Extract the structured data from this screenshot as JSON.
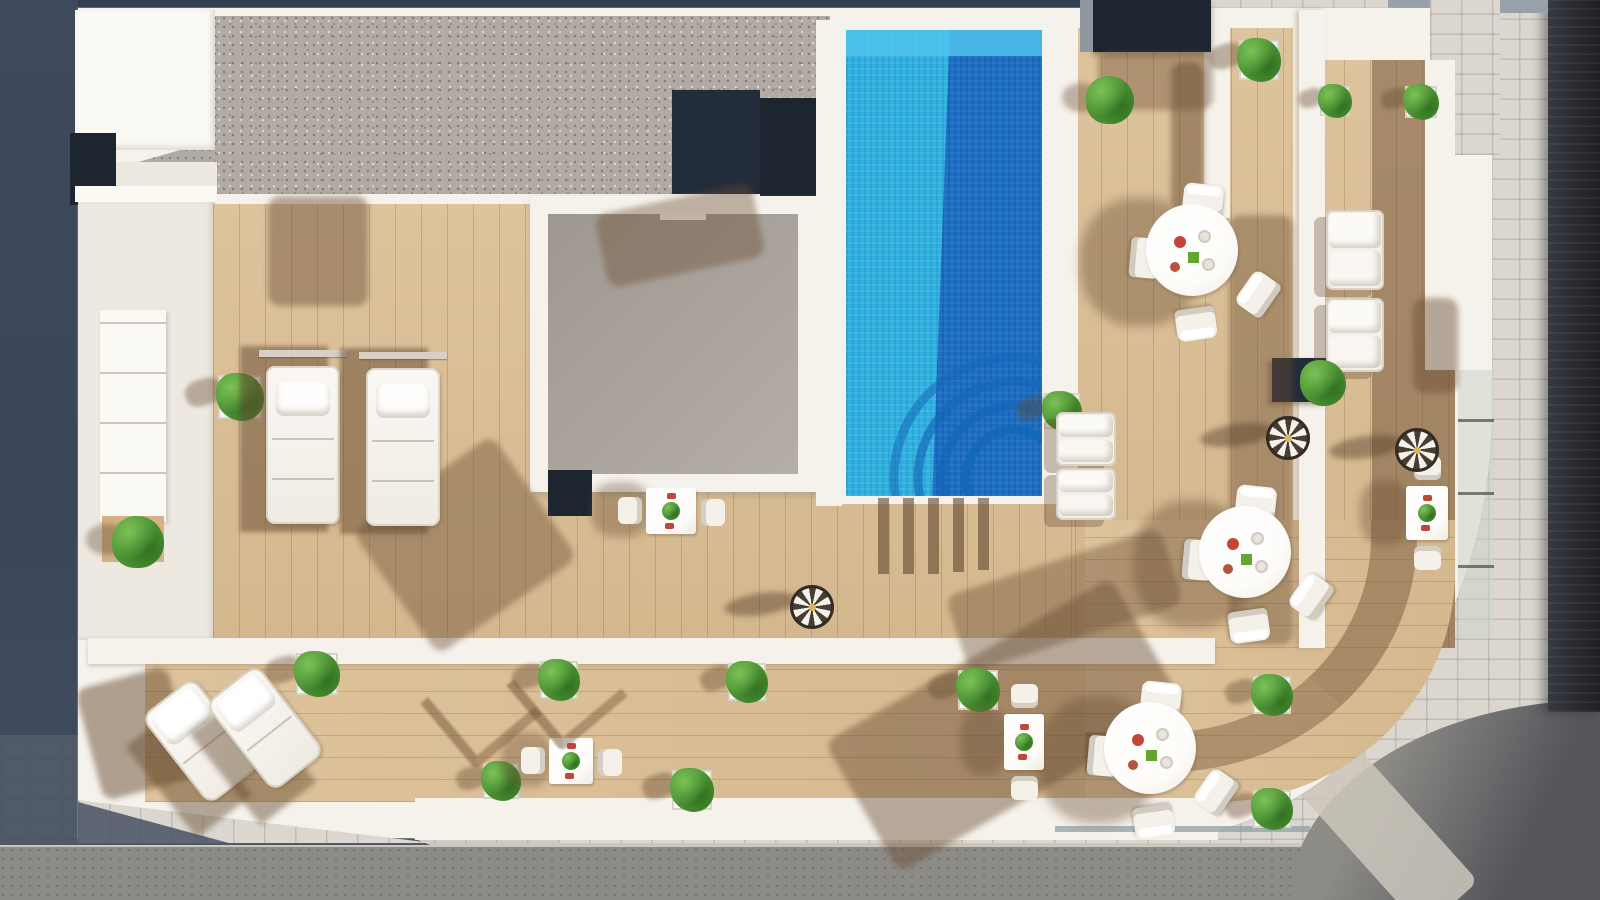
{
  "scene": {
    "label": "rooftop-terrace-aerial-render",
    "width": 1600,
    "height": 900
  },
  "palette": {
    "slate": "#3E4A5C",
    "slate_dark": "#333E4E",
    "navy": "#1D2531",
    "navy2": "#232C3A",
    "white_wall": "#F5F2EB",
    "white_soft": "#EDE9E0",
    "white_bright": "#FBF9F4",
    "gravel": "#B2ABA3",
    "gravel_dot_dark": "#857E76",
    "gravel_dot_light": "#DCD7CF",
    "wood": "#DBBF95",
    "wood2": "#D2B286",
    "wood_line": "rgba(125,95,60,.28)",
    "wood_dark": "#8B6F51",
    "shadow_brown": "rgba(104,76,50,.5)",
    "courtyard": "#A9A29A",
    "courtyard2": "#B5AEA6",
    "pool_light": "#2FB2E1",
    "pool_shallow": "#4FC3EC",
    "pool_dark": "#1C6FC4",
    "pool_steps": "#1467B8",
    "paving": "#DBD7CF",
    "paving_line": "rgba(125,120,110,.28)",
    "road": "#8D8B86",
    "road_dark": "#55565C",
    "crosswalk": "#CCC7BC",
    "charcoal": "#2B2D33",
    "charcoal2": "#1E2026",
    "glass": "rgba(205,214,203,.55)",
    "glass_edge": "#8FA0A6",
    "green": "#4C9334",
    "green_hi": "#7CC257",
    "green_dark": "#2F6E1F",
    "table_white": "#FDFCF9",
    "chair_white": "#F4F1EA",
    "rail": "#D6D0C6",
    "parasol_dark": "#463D33",
    "item_red": "#C5443A",
    "item_green": "#63A52F",
    "item_cup": "#E8E4DC"
  },
  "furniture": {
    "planters": [
      {
        "x": 218,
        "y": 375,
        "s": 44
      },
      {
        "x": 1239,
        "y": 40,
        "s": 40
      },
      {
        "x": 1320,
        "y": 86,
        "s": 30
      },
      {
        "x": 1405,
        "y": 86,
        "s": 32
      },
      {
        "x": 1044,
        "y": 393,
        "s": 36
      },
      {
        "x": 296,
        "y": 653,
        "s": 42
      },
      {
        "x": 540,
        "y": 661,
        "s": 38
      },
      {
        "x": 728,
        "y": 663,
        "s": 38
      },
      {
        "x": 958,
        "y": 670,
        "s": 40
      },
      {
        "x": 1253,
        "y": 676,
        "s": 38
      },
      {
        "x": 672,
        "y": 770,
        "s": 40
      },
      {
        "x": 1253,
        "y": 790,
        "s": 38
      },
      {
        "x": 483,
        "y": 763,
        "s": 36
      }
    ],
    "bushes": [
      {
        "x": 112,
        "y": 516,
        "d": 52
      },
      {
        "x": 1086,
        "y": 76,
        "d": 48
      }
    ],
    "round_tables": [
      {
        "x": 1192,
        "y": 250
      },
      {
        "x": 1245,
        "y": 552
      },
      {
        "x": 1150,
        "y": 748
      }
    ],
    "small_tables": [
      {
        "x": 646,
        "y": 488,
        "w": 50,
        "h": 46,
        "orient": "lr"
      },
      {
        "x": 549,
        "y": 738,
        "w": 44,
        "h": 46,
        "orient": "lr"
      },
      {
        "x": 1004,
        "y": 714,
        "w": 40,
        "h": 56,
        "orient": "tb"
      },
      {
        "x": 1406,
        "y": 486,
        "w": 42,
        "h": 54,
        "orient": "tb"
      }
    ],
    "parasols": [
      {
        "x": 812,
        "y": 607
      },
      {
        "x": 1288,
        "y": 438
      },
      {
        "x": 1417,
        "y": 450
      }
    ],
    "sun_loungers": [
      {
        "x": 266,
        "y": 366
      },
      {
        "x": 366,
        "y": 368
      }
    ],
    "angled_loungers": [
      {
        "x": 168,
        "y": 685,
        "rot": -38
      },
      {
        "x": 232,
        "y": 672,
        "rot": -38
      }
    ],
    "frame_shadows": [
      {
        "x": 438,
        "y": 666,
        "rot": -40
      },
      {
        "x": 524,
        "y": 648,
        "rot": -40
      }
    ],
    "cushion_benches": [
      {
        "x": 1326,
        "y": 210,
        "w": 58,
        "h": 80
      },
      {
        "x": 1326,
        "y": 298,
        "w": 58,
        "h": 74
      },
      {
        "x": 1056,
        "y": 412,
        "w": 60,
        "h": 54
      },
      {
        "x": 1056,
        "y": 468,
        "w": 60,
        "h": 52
      }
    ],
    "box_plant": {
      "x": 1300,
      "y": 360,
      "d": 46
    },
    "shadow_patches": [
      {
        "x": 268,
        "y": 196,
        "w": 100,
        "h": 110,
        "rot": 0,
        "op": 0.45
      },
      {
        "x": 600,
        "y": 198,
        "w": 160,
        "h": 75,
        "rot": -12,
        "op": 0.4
      },
      {
        "x": 380,
        "y": 470,
        "w": 170,
        "h": 150,
        "rot": -35,
        "op": 0.42
      },
      {
        "x": 1171,
        "y": 62,
        "w": 33,
        "h": 150,
        "rot": 0,
        "op": 0.5
      },
      {
        "x": 1229,
        "y": 215,
        "w": 64,
        "h": 430,
        "rot": 0,
        "op": 0.42
      },
      {
        "x": 840,
        "y": 650,
        "w": 330,
        "h": 150,
        "rot": -30,
        "op": 0.45
      },
      {
        "x": 88,
        "y": 676,
        "w": 95,
        "h": 115,
        "rot": -15,
        "op": 0.5
      },
      {
        "x": 952,
        "y": 560,
        "w": 225,
        "h": 80,
        "rot": -18,
        "op": 0.4
      },
      {
        "x": 1413,
        "y": 298,
        "w": 45,
        "h": 95,
        "rot": 0,
        "op": 0.45
      },
      {
        "x": 1098,
        "y": 52,
        "w": 115,
        "h": 58,
        "rot": 0,
        "op": 0.4
      }
    ],
    "ladder_stripes": [
      {
        "x": 878,
        "y": 498,
        "w": 11,
        "h": 76
      },
      {
        "x": 903,
        "y": 498,
        "w": 11,
        "h": 76
      },
      {
        "x": 928,
        "y": 498,
        "w": 11,
        "h": 76
      },
      {
        "x": 953,
        "y": 498,
        "w": 11,
        "h": 74
      },
      {
        "x": 978,
        "y": 498,
        "w": 11,
        "h": 72
      }
    ],
    "pool_step_arcs": {
      "cx": 168,
      "cy": 448,
      "radii": [
        48,
        72,
        96,
        120
      ]
    }
  }
}
